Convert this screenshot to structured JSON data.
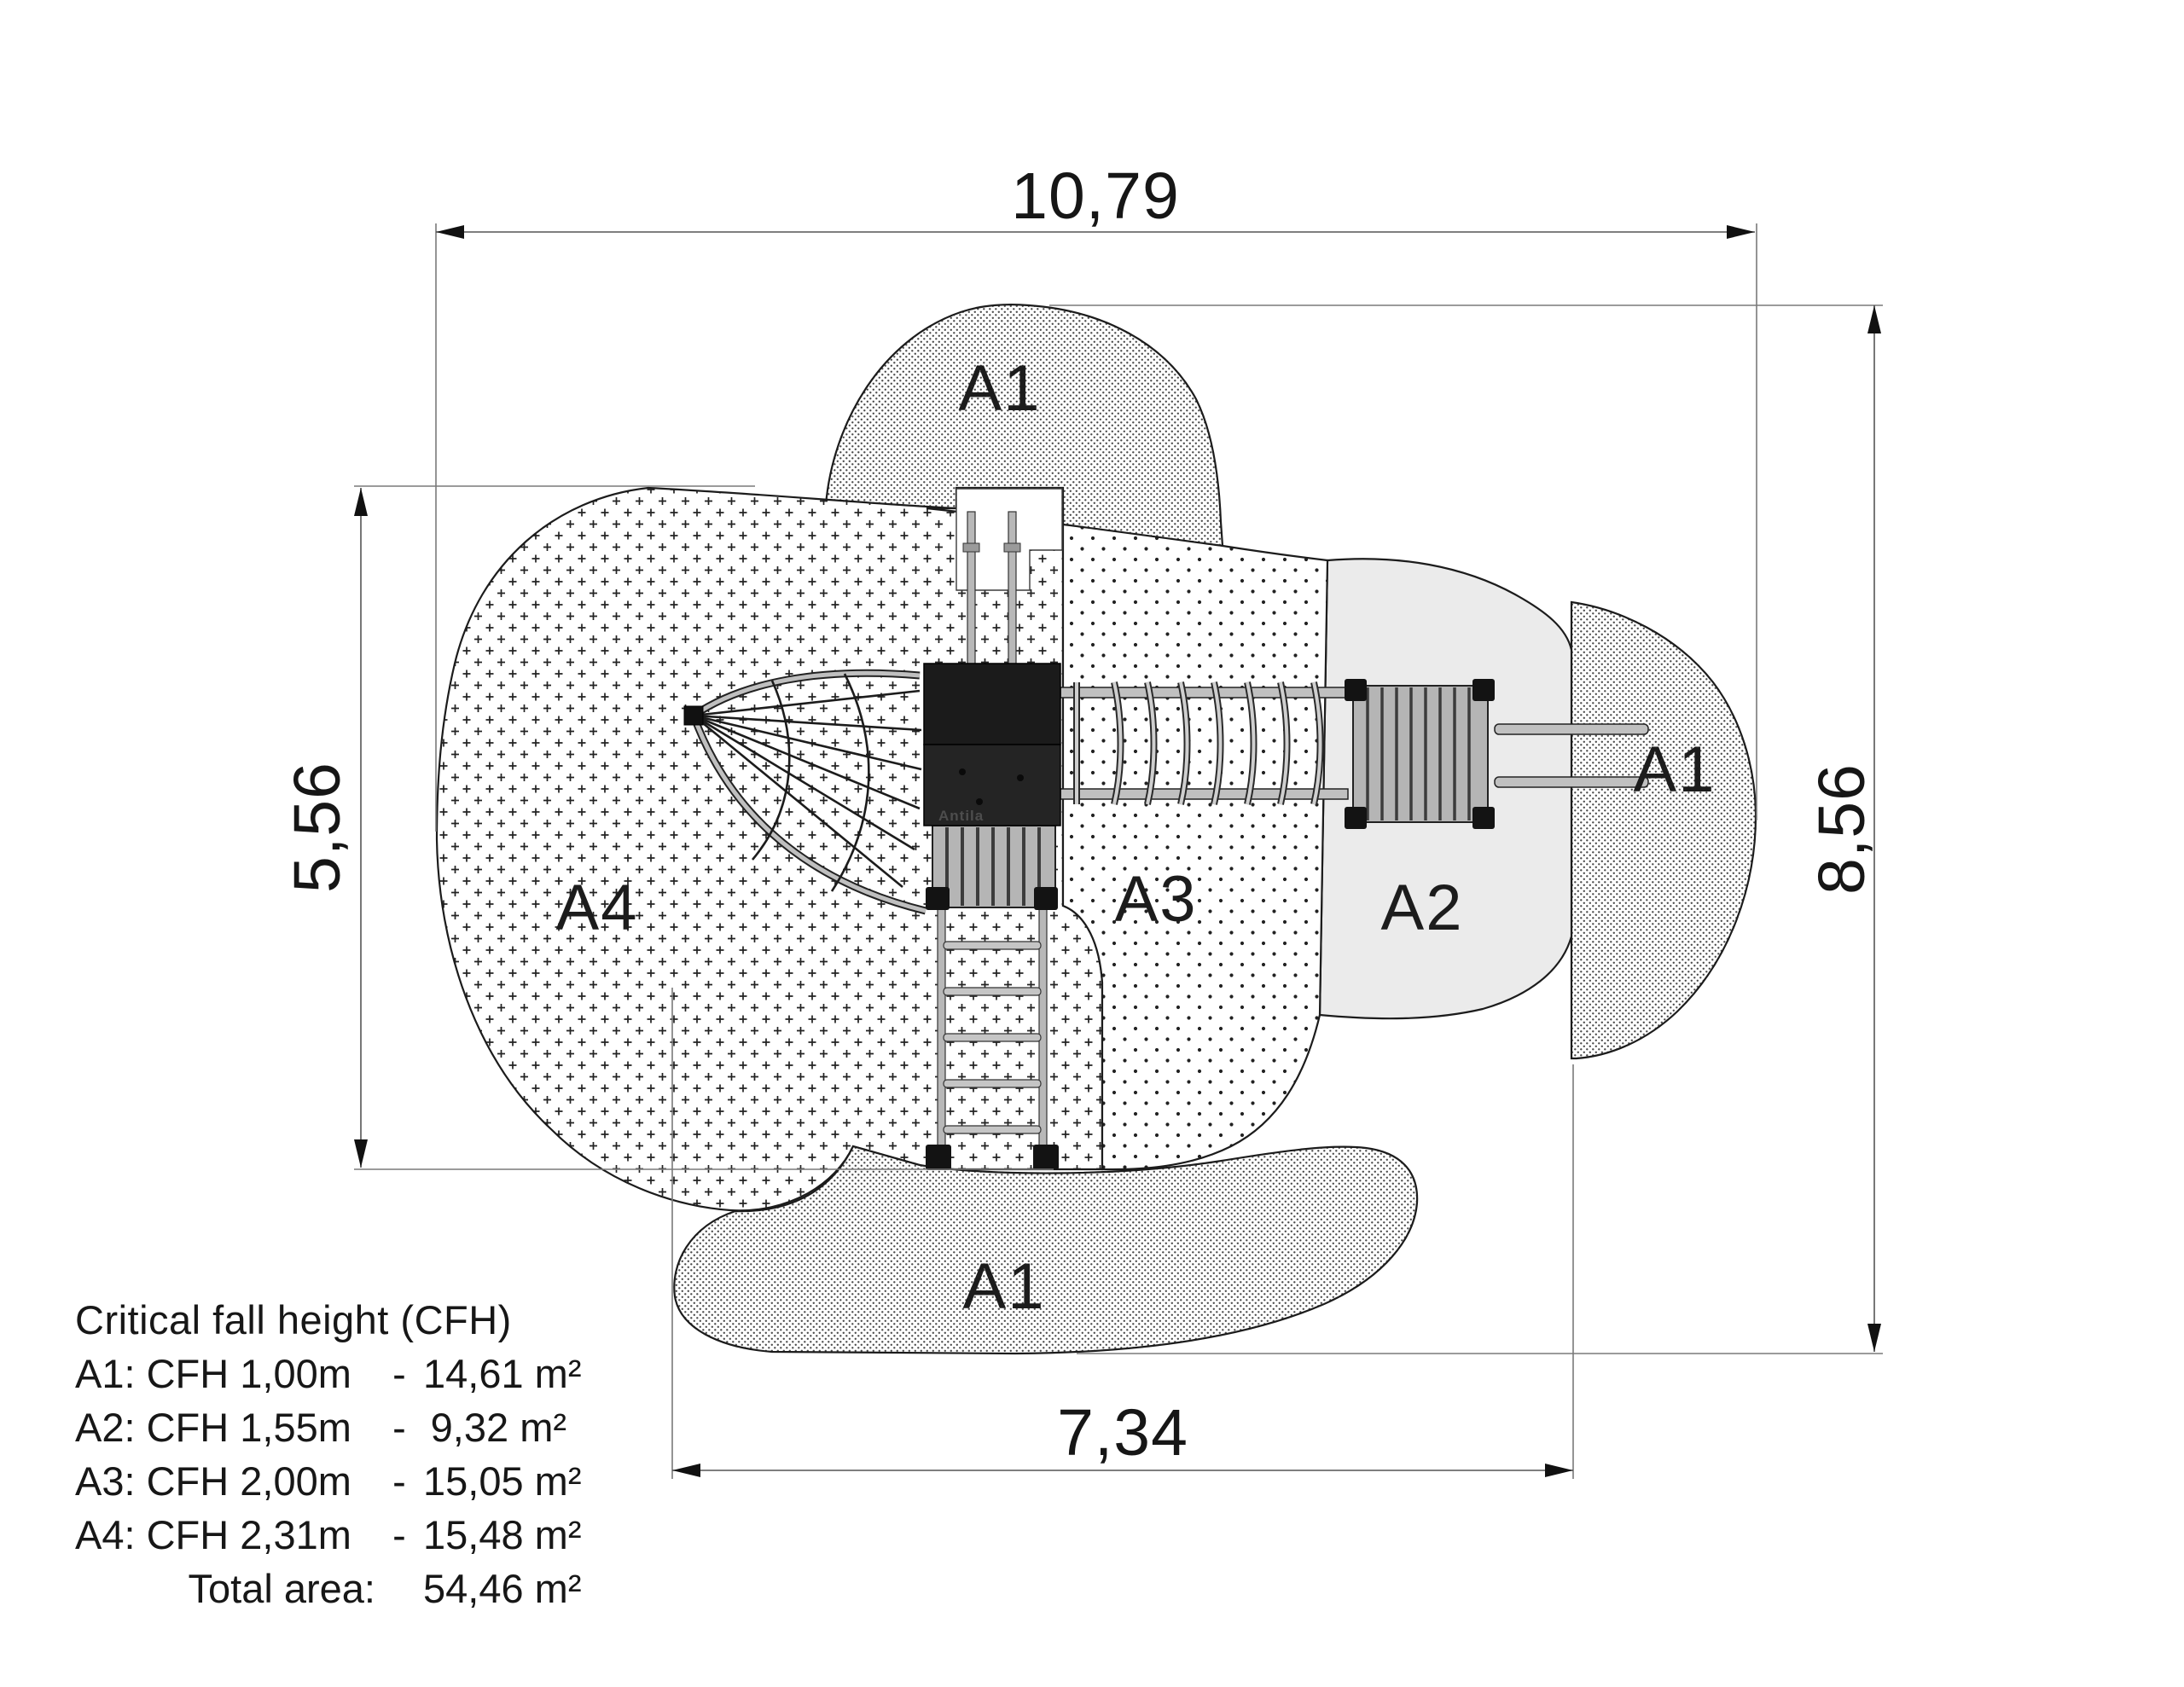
{
  "dimensions": {
    "top": "10,79",
    "bottom": "7,34",
    "left": "5,56",
    "right": "8,56"
  },
  "zones": {
    "a1_top": "A1",
    "a1_right": "A1",
    "a1_bottom": "A1",
    "a2": "A2",
    "a3": "A3",
    "a4": "A4"
  },
  "structure": {
    "brand": "Antila"
  },
  "legend": {
    "title": "Critical fall height (CFH)",
    "rows": [
      {
        "label": "A1: CFH 1,00m",
        "sep": "-",
        "value": "14,61 m²"
      },
      {
        "label": "A2: CFH 1,55m",
        "sep": "-",
        "value": "9,32 m²"
      },
      {
        "label": "A3: CFH 2,00m",
        "sep": "-",
        "value": "15,05 m²"
      },
      {
        "label": "A4: CFH 2,31m",
        "sep": "-",
        "value": "15,48 m²"
      }
    ],
    "total_label": "Total area:",
    "total_value": "54,46 m²"
  },
  "colors": {
    "line": "#1c1c1c",
    "dim_line": "#7a7a7a",
    "a2_fill": "#ebebeb",
    "pattern_ink": "#222222",
    "tower_dark": "#1b1b1b",
    "metal_gray": "#c0c0c0"
  }
}
